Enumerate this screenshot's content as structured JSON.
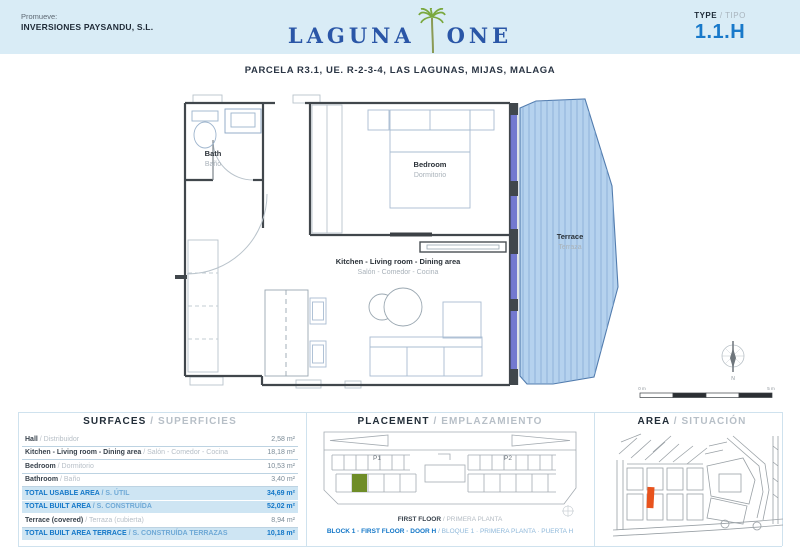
{
  "header": {
    "promoter_label": "Promueve:",
    "promoter_name": "INVERSIONES PAYSANDU, S.L.",
    "logo_word1": "LAGUNA",
    "logo_word2": "ONE",
    "type_label": "TYPE",
    "type_label_es": " / TIPO",
    "type_value": "1.1.H"
  },
  "subtitle": "PARCELA R3.1, UE. R-2-3-4, LAS LAGUNAS, MIJAS, MALAGA",
  "floorplan": {
    "rooms": {
      "bath": {
        "en": "Bath",
        "es": "Baño"
      },
      "bedroom": {
        "en": "Bedroom",
        "es": "Dormitorio"
      },
      "living": {
        "en": "Kitchen - Living room - Dining area",
        "es": "Salón - Comedor - Cocina"
      },
      "terrace": {
        "en": "Terrace",
        "es": "Terraza"
      }
    },
    "compass_letter": "N",
    "scale_start": "0 m",
    "scale_end": "5 m"
  },
  "surfaces": {
    "title_en": "SURFACES",
    "title_es": " / SUPERFICIES",
    "rows": [
      {
        "label_en": "Hall ",
        "label_es": "/ Distribuidor",
        "value": "2,58 m²"
      },
      {
        "label_en": "Kitchen - Living room - Dining area ",
        "label_es": "/ Salón - Comedor - Cocina",
        "value": "18,18 m²"
      },
      {
        "label_en": "Bedroom ",
        "label_es": "/ Dormitorio",
        "value": "10,53 m²"
      },
      {
        "label_en": "Bathroom ",
        "label_es": "/ Baño",
        "value": "3,40 m²"
      },
      {
        "label_en": "TOTAL USABLE AREA ",
        "label_es": "/ S. ÚTIL",
        "value": "34,69 m²"
      },
      {
        "label_en": "TOTAL BUILT AREA ",
        "label_es": "/ S. CONSTRUÍDA",
        "value": "52,02 m²"
      },
      {
        "label_en": "Terrace (covered) ",
        "label_es": "/ Terraza (cubierta)",
        "value": "8,94 m²"
      },
      {
        "label_en": "TOTAL BUILT AREA TERRACE ",
        "label_es": "/ S. CONSTRUÍDA TERRAZAS",
        "value": "10,18 m²"
      }
    ]
  },
  "placement": {
    "title_en": "PLACEMENT",
    "title_es": " / EMPLAZAMIENTO",
    "p1": "P1",
    "p2": "P2",
    "floor_en": "FIRST FLOOR ",
    "floor_es": "/ PRIMERA PLANTA",
    "unit_en": "BLOCK 1 · FIRST FLOOR · DOOR H ",
    "unit_es": "/ BLOQUE 1 · PRIMERA PLANTA · PUERTA H"
  },
  "area_map": {
    "title_en": "AREA",
    "title_es": " / SITUACIÓN"
  },
  "colors": {
    "accent_blue": "#1377c8",
    "header_bg": "#d9ecf6",
    "logo_blue": "#2a56a7",
    "palm_green": "#7aa83f",
    "terrace_fill": "#b5d2ee",
    "highlight_row_bg": "#cee5f3",
    "unit_green": "#6f8d28",
    "parcel_orange": "#e8531d"
  }
}
